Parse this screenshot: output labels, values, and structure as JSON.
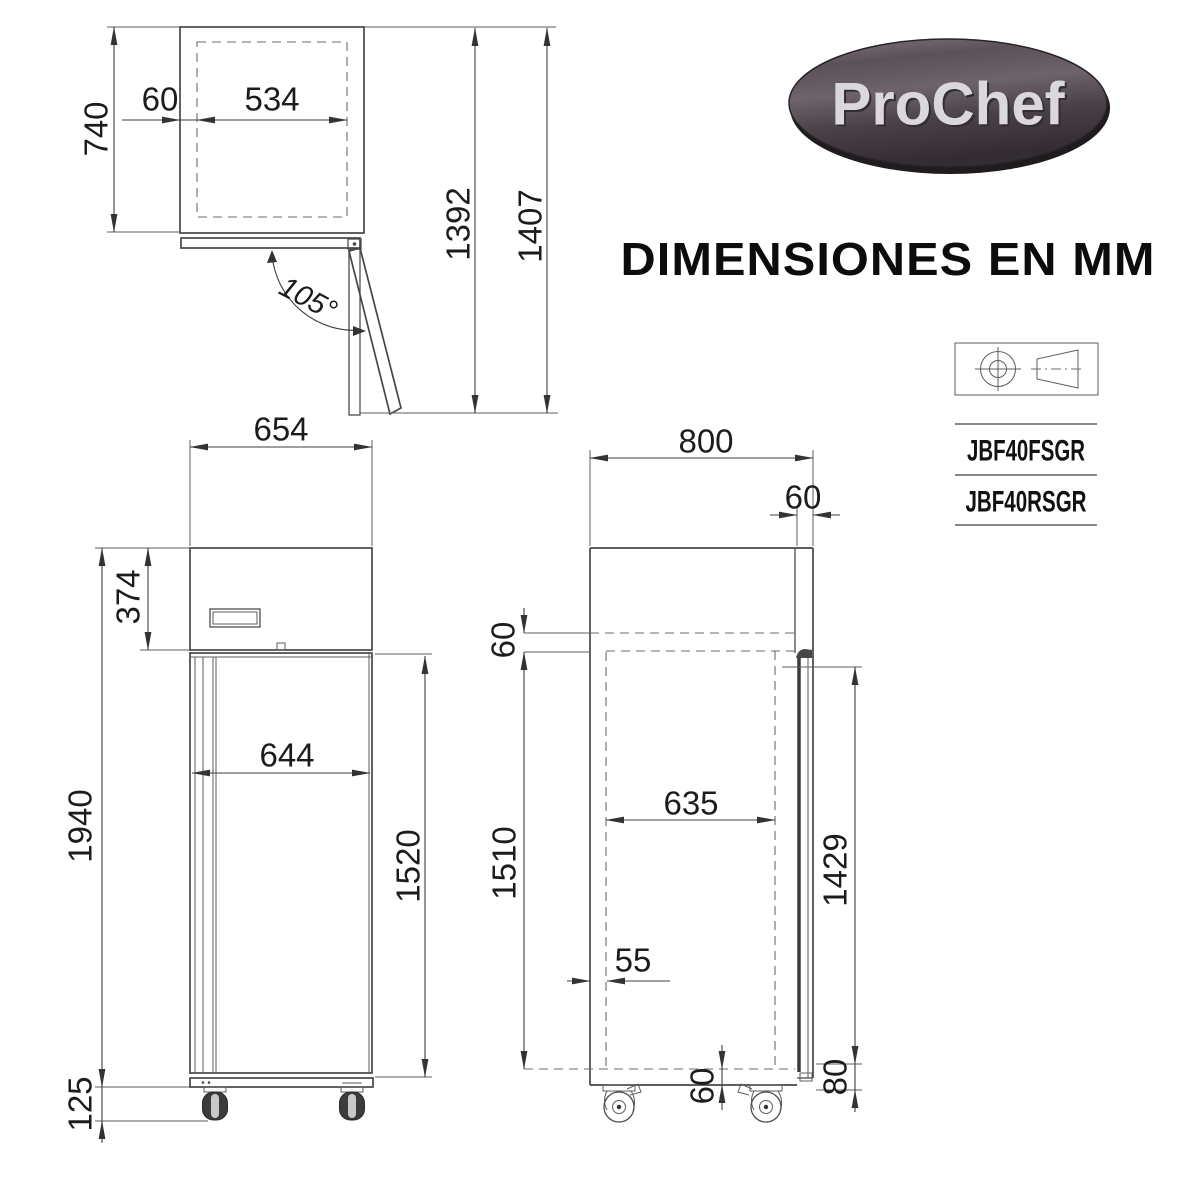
{
  "brand": {
    "name": "ProChef"
  },
  "title": "DIMENSIONES EN MM",
  "models": {
    "model_1": "JBF40FSGR",
    "model_2": "JBF40RSGR"
  },
  "top_view": {
    "dims": {
      "depth": "740",
      "door_inset": "60",
      "inner_width": "534",
      "swing_depth": "1392",
      "max_depth": "1407",
      "door_angle": "105°"
    }
  },
  "front_view": {
    "dims": {
      "width": "654",
      "header_height": "374",
      "door_width": "644",
      "door_height": "1520",
      "body_height": "1940",
      "caster_height": "125"
    }
  },
  "side_view": {
    "dims": {
      "depth": "800",
      "door_thickness": "60",
      "top_clearance": "60",
      "interior_depth": "635",
      "interior_height": "1510",
      "door_length": "1429",
      "front_offset": "55",
      "bottom_clearance": "60",
      "door_gap": "80"
    }
  }
}
